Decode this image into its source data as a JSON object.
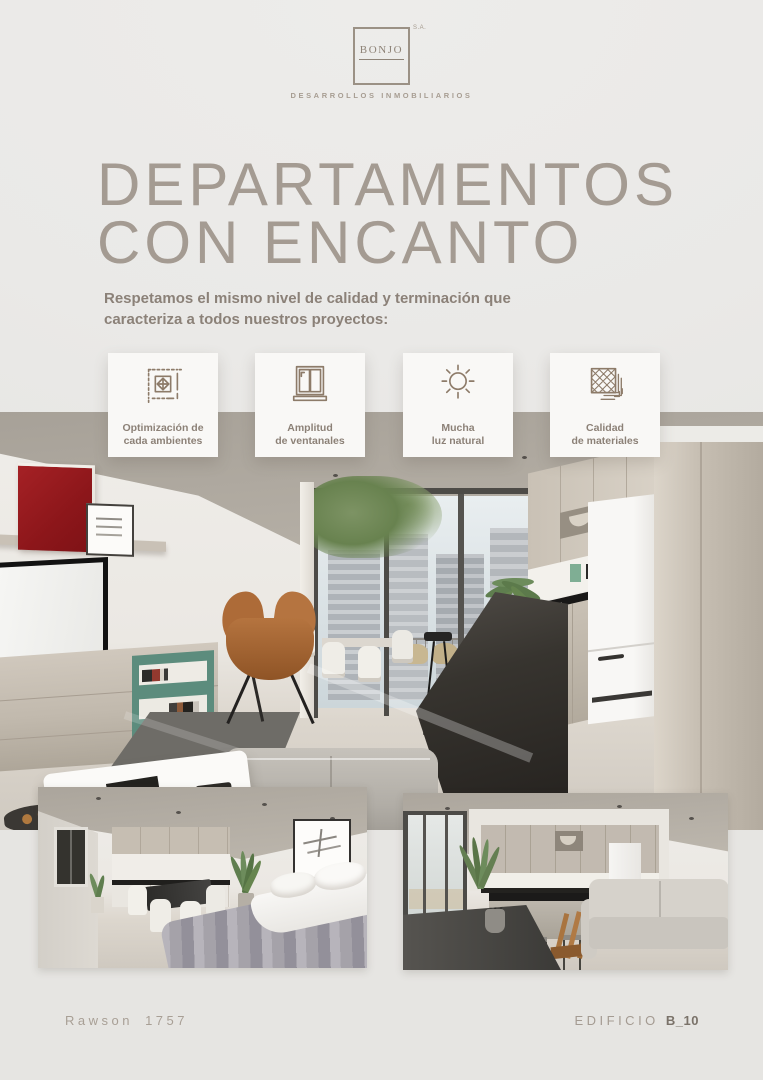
{
  "header": {
    "logo_text": "BONJO",
    "logo_suffix": "S.A.",
    "logo_tagline": "DESARROLLOS INMOBILIARIOS"
  },
  "title": {
    "line1": "DEPARTAMENTOS",
    "line2": "CON ENCANTO"
  },
  "intro": {
    "line1": "Respetamos el mismo nivel de calidad y terminación que",
    "line2": "caracteriza a todos nuestros proyectos:"
  },
  "features": [
    {
      "icon": "floor-plan-dimensions-icon",
      "line1": "Optimización de",
      "line2": "cada ambientes"
    },
    {
      "icon": "window-icon",
      "line1": "Amplitud",
      "line2": "de ventanales"
    },
    {
      "icon": "sun-icon",
      "line1": "Mucha",
      "line2": "luz natural"
    },
    {
      "icon": "floor-tiles-icon",
      "line1": "Calidad",
      "line2": "de materiales"
    }
  ],
  "photos": {
    "main": "living-dining-kitchen-render",
    "bottom_left": "studio-bedroom-render",
    "bottom_right": "kitchen-island-living-render"
  },
  "footer": {
    "address": "Rawson 1757",
    "building_label": "EDIFICIO",
    "building_code": "B_10"
  },
  "colors": {
    "page_background": "#eae9e7",
    "accent_taupe": "#8d7b69",
    "title_color": "#a49b92",
    "body_text": "#8b8178",
    "card_background": "#f9f8f6",
    "footer_text": "#a89f95",
    "footer_code": "#7a7269",
    "art_red": "#9c1c1f",
    "shelf_green": "#5d8d7e",
    "leather_brown": "#b0713f"
  }
}
